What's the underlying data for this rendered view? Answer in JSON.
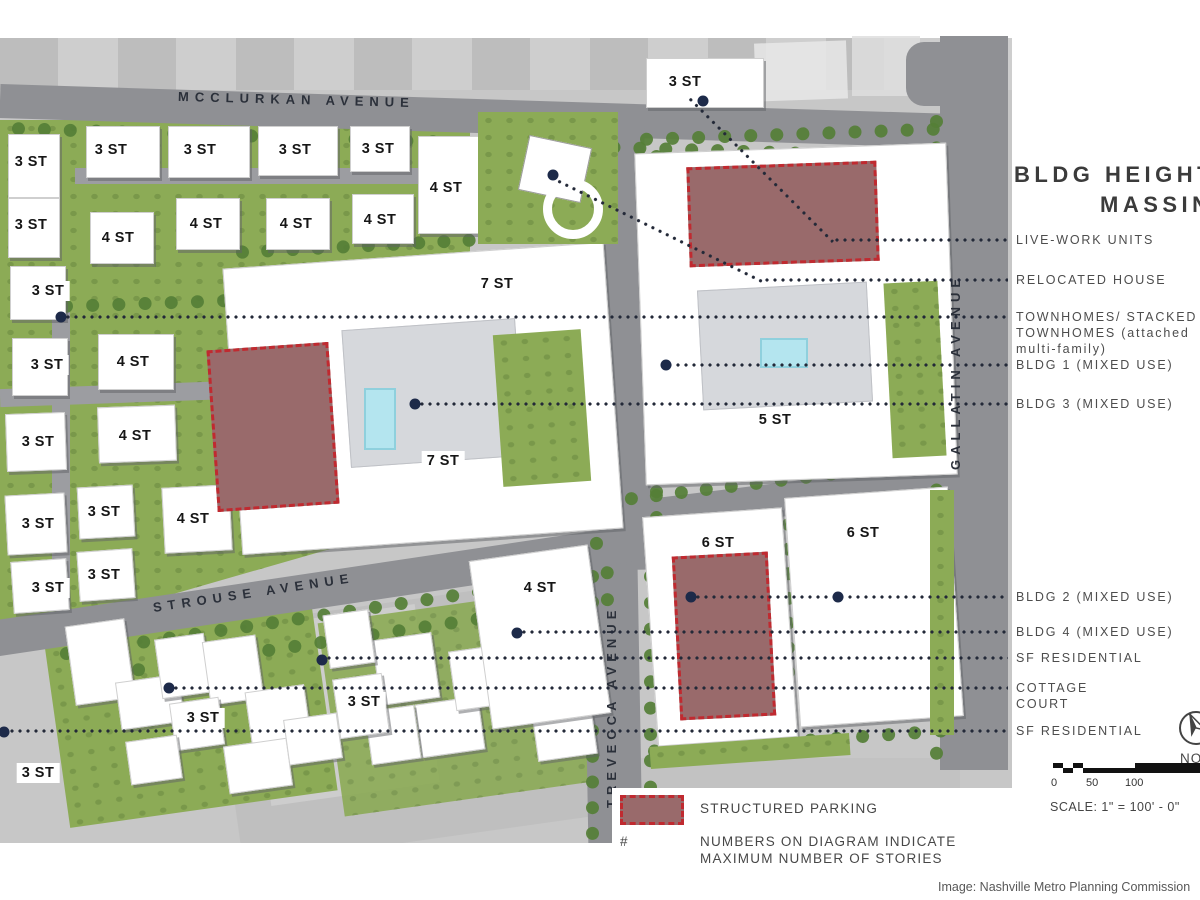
{
  "title": {
    "line1": "BLDG HEIGHTS",
    "line2": "MASSING"
  },
  "streets": {
    "mcclurkan": "MCCLURKAN AVENUE",
    "gallatin": "GALLATIN AVENUE",
    "strouse": "STROUSE AVENUE",
    "trevecca": "TREVECCA AVENUE"
  },
  "legend": {
    "items": [
      {
        "lines": [
          "LIVE-WORK UNITS"
        ],
        "y": 240,
        "x0": 833
      },
      {
        "lines": [
          "RELOCATED HOUSE"
        ],
        "y": 280,
        "x0": 763
      },
      {
        "lines": [
          "TOWNHOMES/ STACKED",
          "TOWNHOMES (attached",
          "multi-family)"
        ],
        "y": 317,
        "x0": 64
      },
      {
        "lines": [
          "BLDG 1 (MIXED USE)"
        ],
        "y": 365,
        "x0": 666
      },
      {
        "lines": [
          "BLDG 3 (MIXED USE)"
        ],
        "y": 404,
        "x0": 418
      },
      {
        "lines": [
          "BLDG 2 (MIXED USE)"
        ],
        "y": 597,
        "x0": 694
      },
      {
        "lines": [
          "BLDG 4 (MIXED USE)"
        ],
        "y": 632,
        "x0": 520
      },
      {
        "lines": [
          "SF RESIDENTIAL"
        ],
        "y": 658,
        "x0": 325
      },
      {
        "lines": [
          "COTTAGE",
          "COURT"
        ],
        "y": 688,
        "x0": 172
      },
      {
        "lines": [
          "SF RESIDENTIAL"
        ],
        "y": 731,
        "x0": 0
      }
    ]
  },
  "map": {
    "story_labels": [
      {
        "t": "3 ST",
        "x": 31,
        "y": 162
      },
      {
        "t": "3 ST",
        "x": 111,
        "y": 150
      },
      {
        "t": "3 ST",
        "x": 200,
        "y": 150
      },
      {
        "t": "3 ST",
        "x": 295,
        "y": 150
      },
      {
        "t": "3 ST",
        "x": 378,
        "y": 149
      },
      {
        "t": "4 ST",
        "x": 446,
        "y": 188
      },
      {
        "t": "3 ST",
        "x": 31,
        "y": 225
      },
      {
        "t": "4 ST",
        "x": 118,
        "y": 238
      },
      {
        "t": "4 ST",
        "x": 206,
        "y": 224
      },
      {
        "t": "4 ST",
        "x": 296,
        "y": 224
      },
      {
        "t": "4 ST",
        "x": 380,
        "y": 220
      },
      {
        "t": "3 ST",
        "x": 48,
        "y": 291
      },
      {
        "t": "3 ST",
        "x": 47,
        "y": 365
      },
      {
        "t": "4 ST",
        "x": 133,
        "y": 362
      },
      {
        "t": "3 ST",
        "x": 38,
        "y": 442
      },
      {
        "t": "4 ST",
        "x": 135,
        "y": 436
      },
      {
        "t": "3 ST",
        "x": 38,
        "y": 524
      },
      {
        "t": "3 ST",
        "x": 104,
        "y": 512
      },
      {
        "t": "4 ST",
        "x": 193,
        "y": 519
      },
      {
        "t": "3 ST",
        "x": 48,
        "y": 588
      },
      {
        "t": "3 ST",
        "x": 104,
        "y": 575
      },
      {
        "t": "3 ST",
        "x": 685,
        "y": 82
      },
      {
        "t": "7 ST",
        "x": 497,
        "y": 284
      },
      {
        "t": "7 ST",
        "x": 443,
        "y": 461
      },
      {
        "t": "5 ST",
        "x": 775,
        "y": 420
      },
      {
        "t": "6 ST",
        "x": 718,
        "y": 543
      },
      {
        "t": "6 ST",
        "x": 863,
        "y": 533
      },
      {
        "t": "4 ST",
        "x": 540,
        "y": 588
      },
      {
        "t": "3 ST",
        "x": 203,
        "y": 718
      },
      {
        "t": "3 ST",
        "x": 364,
        "y": 702
      },
      {
        "t": "3 ST",
        "x": 38,
        "y": 773
      }
    ],
    "buildings": [
      [
        8,
        134,
        50,
        62,
        0
      ],
      [
        86,
        126,
        72,
        50,
        0
      ],
      [
        168,
        126,
        80,
        50,
        0
      ],
      [
        258,
        126,
        78,
        48,
        0
      ],
      [
        350,
        126,
        58,
        44,
        0
      ],
      [
        418,
        136,
        60,
        96,
        0
      ],
      [
        8,
        198,
        50,
        58,
        0
      ],
      [
        90,
        212,
        62,
        50,
        0
      ],
      [
        176,
        198,
        62,
        50,
        0
      ],
      [
        266,
        198,
        62,
        50,
        0
      ],
      [
        352,
        194,
        60,
        48,
        0
      ],
      [
        10,
        266,
        54,
        52,
        0
      ],
      [
        12,
        338,
        54,
        56,
        0
      ],
      [
        98,
        334,
        74,
        54,
        0
      ],
      [
        6,
        413,
        58,
        56,
        -2
      ],
      [
        98,
        406,
        76,
        54,
        -2
      ],
      [
        6,
        494,
        58,
        58,
        -3
      ],
      [
        78,
        486,
        54,
        50,
        -3
      ],
      [
        163,
        486,
        66,
        64,
        -3
      ],
      [
        12,
        560,
        54,
        50,
        -4
      ],
      [
        78,
        550,
        54,
        48,
        -4
      ],
      [
        646,
        58,
        116,
        48,
        0
      ],
      [
        70,
        622,
        58,
        78,
        -8
      ],
      [
        118,
        678,
        62,
        46,
        -8
      ],
      [
        158,
        636,
        48,
        58,
        -8
      ],
      [
        206,
        638,
        52,
        62,
        -8
      ],
      [
        248,
        688,
        58,
        52,
        -8
      ],
      [
        172,
        700,
        48,
        46,
        -8
      ],
      [
        226,
        742,
        62,
        46,
        -8
      ],
      [
        128,
        738,
        50,
        42,
        -8
      ],
      [
        286,
        716,
        52,
        44,
        -8
      ],
      [
        376,
        636,
        58,
        64,
        -8
      ],
      [
        418,
        700,
        62,
        52,
        -8
      ],
      [
        368,
        708,
        48,
        52,
        -8
      ],
      [
        452,
        648,
        48,
        58,
        -8
      ],
      [
        538,
        632,
        48,
        62,
        -8
      ],
      [
        534,
        700,
        58,
        56,
        -8
      ],
      [
        326,
        612,
        44,
        52,
        -8
      ],
      [
        336,
        676,
        48,
        58,
        -8
      ],
      [
        232,
        255,
        380,
        285,
        -4
      ],
      [
        640,
        148,
        310,
        330,
        -2
      ],
      [
        650,
        512,
        138,
        228,
        -4
      ],
      [
        792,
        492,
        162,
        228,
        -4
      ],
      [
        480,
        552,
        118,
        168,
        -8
      ]
    ],
    "parking_structures": [
      [
        688,
        164,
        190,
        100,
        -2
      ],
      [
        212,
        346,
        122,
        162,
        -4
      ],
      [
        676,
        554,
        96,
        164,
        -3
      ]
    ],
    "decks": [
      [
        346,
        324,
        172,
        136,
        -4
      ],
      [
        700,
        286,
        168,
        118,
        -3
      ]
    ],
    "pools": [
      [
        364,
        388,
        28,
        58
      ],
      [
        760,
        338,
        44,
        26
      ]
    ],
    "lawns": [
      [
        498,
        332,
        88,
        152,
        -4
      ],
      [
        888,
        282,
        54,
        175,
        -3
      ],
      [
        478,
        112,
        140,
        132,
        0
      ],
      [
        650,
        740,
        200,
        22,
        -4
      ],
      [
        930,
        490,
        24,
        245,
        0
      ]
    ],
    "dots": [
      [
        553,
        175
      ],
      [
        703,
        101
      ],
      [
        61,
        317
      ],
      [
        666,
        365
      ],
      [
        415,
        404
      ],
      [
        691,
        597
      ],
      [
        838,
        597
      ],
      [
        517,
        633
      ],
      [
        322,
        660
      ],
      [
        169,
        688
      ],
      [
        4,
        732
      ]
    ],
    "diagonal_leaders": [
      {
        "x1": 556,
        "y1": 178,
        "x2": 763,
        "y2": 280
      },
      {
        "x1": 688,
        "y1": 95,
        "x2": 833,
        "y2": 240
      }
    ],
    "tree_rows_h": [
      [
        12,
        122,
        920,
        1.8
      ],
      [
        236,
        246,
        240,
        -3
      ],
      [
        640,
        133,
        300,
        -2
      ],
      [
        600,
        496,
        340,
        -7
      ],
      [
        648,
        745,
        300,
        -4
      ],
      [
        60,
        648,
        560,
        -8.5
      ],
      [
        80,
        672,
        540,
        -8.5
      ],
      [
        60,
        300,
        380,
        -2
      ]
    ],
    "tree_rows_v": [
      [
        930,
        115,
        645
      ],
      [
        590,
        140,
        410
      ],
      [
        650,
        150,
        400
      ],
      [
        586,
        570,
        270
      ],
      [
        644,
        570,
        250
      ],
      [
        782,
        518,
        210
      ]
    ]
  },
  "footer_legend": {
    "parking_label": "STRUCTURED PARKING",
    "hash_symbol": "#",
    "note_line1": "NUMBERS ON DIAGRAM INDICATE",
    "note_line2": "MAXIMUM NUMBER OF STORIES"
  },
  "scale": {
    "ticks": [
      "0",
      "50",
      "100"
    ],
    "text": "SCALE: 1\" = 100' - 0\""
  },
  "north": {
    "label": "NORTH"
  },
  "attribution": "Image: Nashville Metro Planning Commission",
  "colors": {
    "parking_fill": "#996a6b",
    "parking_border": "#c02a30",
    "road": "#8f9094",
    "grass": "#8cab56",
    "tree": "#557f37",
    "building": "#ffffff",
    "pool": "#b4e5ef",
    "leader_dot": "#1d2a49"
  }
}
